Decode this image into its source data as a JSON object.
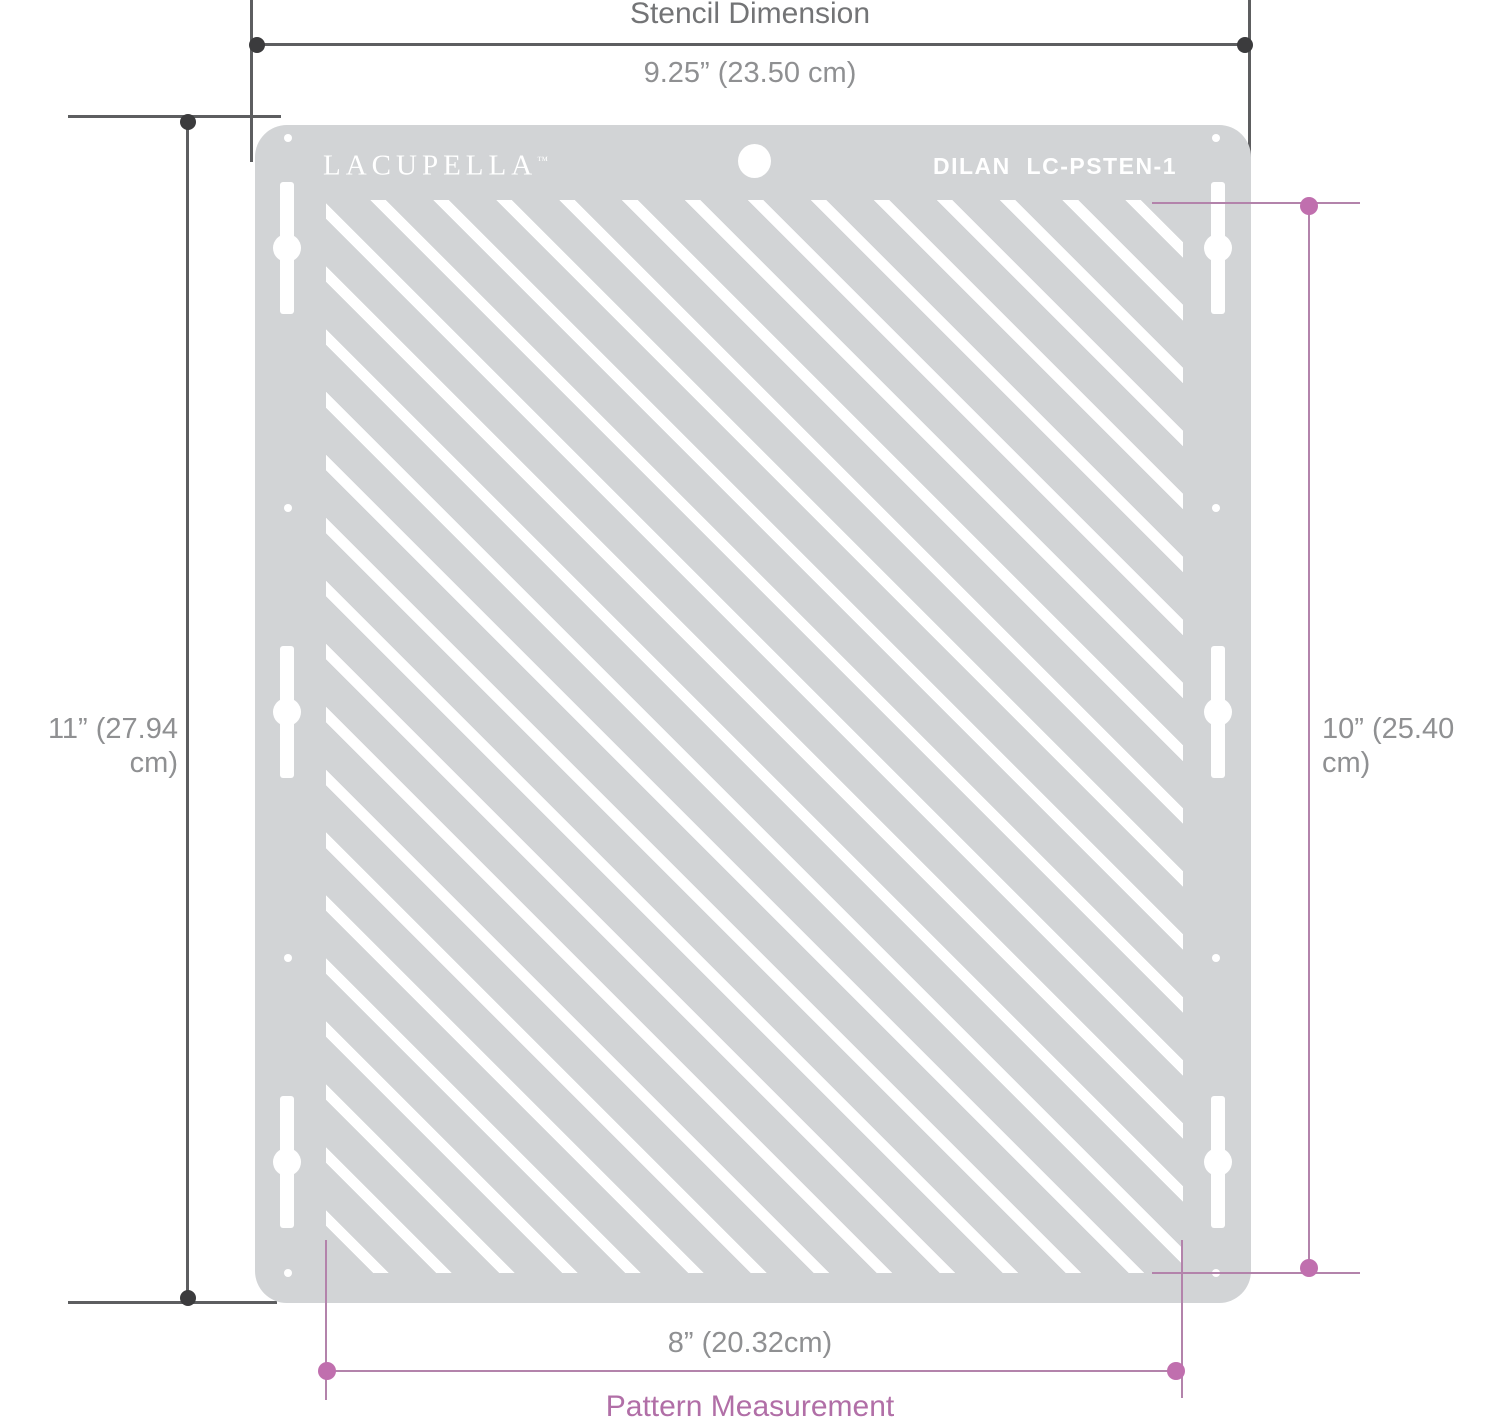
{
  "diagram": {
    "title": "Stencil Dimension",
    "measurements": {
      "stencil_width": "9.25” (23.50 cm)",
      "stencil_height": "11” (27.94 cm)",
      "pattern_height": "10” (25.40 cm)",
      "pattern_width": "8” (20.32cm)",
      "pattern_label": "Pattern Measurement"
    },
    "stencil": {
      "brand": "LACUPELLA",
      "brand_mark": "™",
      "model": "DILAN  LC-PSTEN-1"
    },
    "colors": {
      "plate_gray": "#d2d4d6",
      "cutout_white": "#ffffff",
      "dark_line": "#5d5e60",
      "dark_dot": "#3b3b3d",
      "gray_text": "#8f9092",
      "title_text": "#737476",
      "pink_line": "#b383ab",
      "pink_dot": "#c06fae",
      "pink_text": "#b16fa7"
    }
  }
}
